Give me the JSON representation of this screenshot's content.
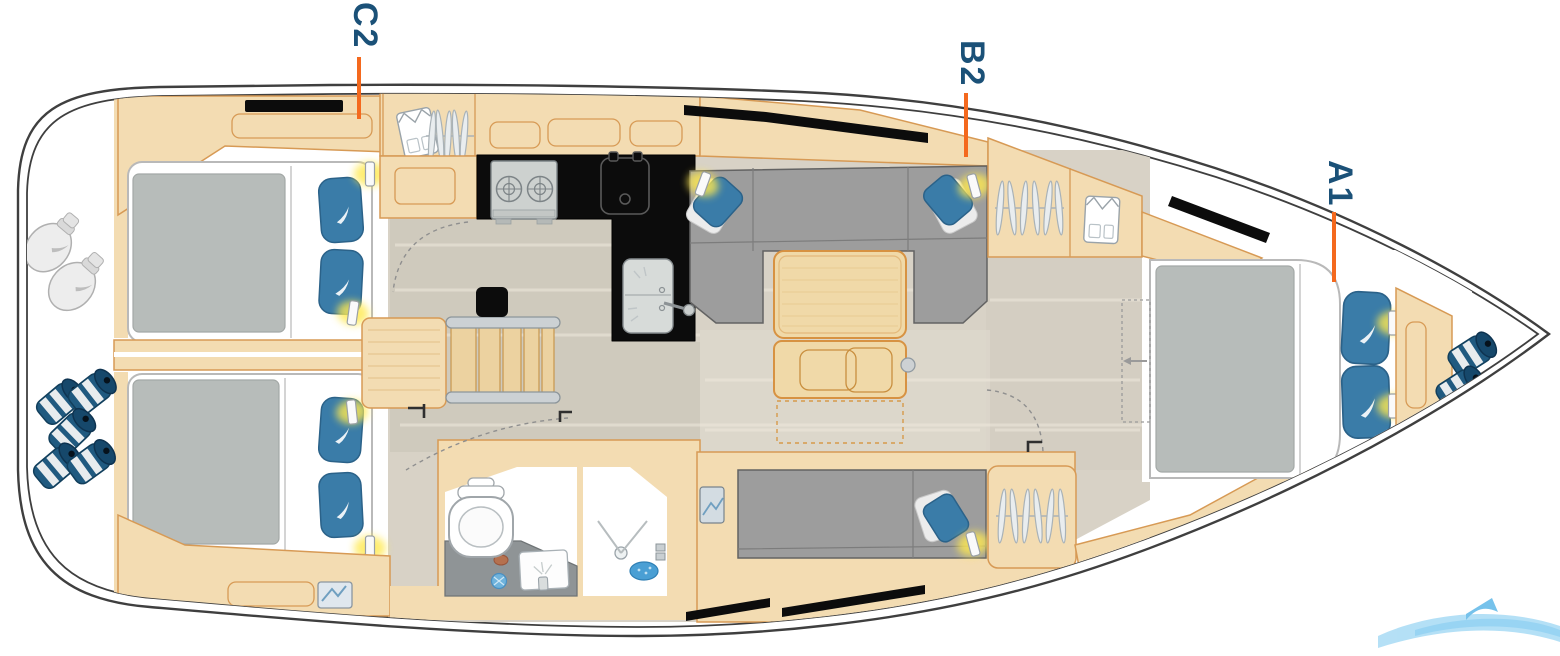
{
  "plan": {
    "labels": [
      {
        "id": "c2",
        "text": "C2"
      },
      {
        "id": "b2",
        "text": "B2"
      },
      {
        "id": "a1",
        "text": "A1"
      }
    ],
    "colors": {
      "label_text": "#1b5178",
      "leader_line": "#f4691e",
      "hull_line": "#3f3f3f",
      "wood": "#f3dcb2",
      "wood_outline": "#d79a55",
      "floor": "#d8d2c6",
      "upholstery_gray": "#9d9d9d",
      "mattress_gray": "#b7bcba",
      "pillow_blue": "#3a7ca8",
      "counter_black": "#0c0c0c",
      "reading_light_glow": "#ffe94f",
      "fender_blue": "#205a80",
      "watermark_blue": "#a8dbf5"
    },
    "icons": [
      "folded-shirt-icon",
      "hanger-rack-icon",
      "stove-icon",
      "fridge-icon",
      "sink-icon",
      "toilet-icon",
      "shower-icon",
      "reading-light-icon",
      "pillow-icon",
      "fender-icon",
      "deck-hatch-icon",
      "door-swing-icon",
      "stairs-icon",
      "table-icon",
      "watermark-swoosh-icon"
    ]
  }
}
